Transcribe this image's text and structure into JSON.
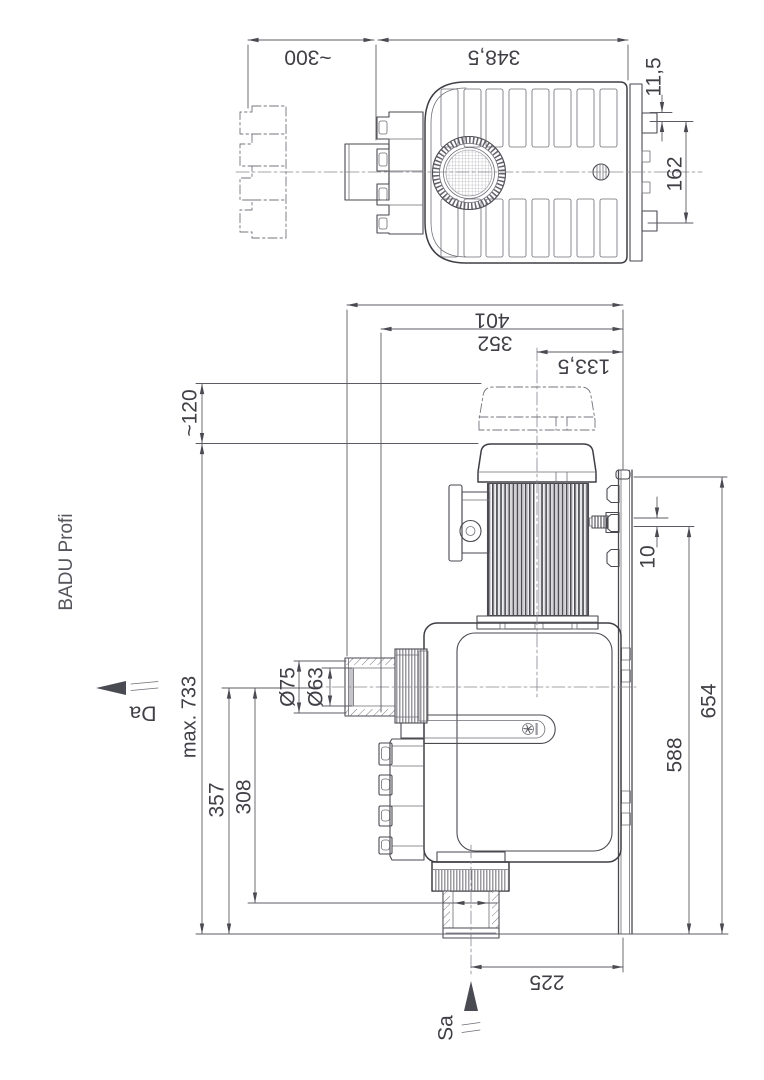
{
  "drawing": {
    "title": "BADU Profi",
    "flow_labels": {
      "discharge": "Da",
      "suction": "Sa"
    },
    "top_view_dims": {
      "removal_clearance": "~300",
      "housing_length": "348,5",
      "flange_offset": "11,5",
      "flange_spacing": "162"
    },
    "front_view_dims": {
      "overall_depth": "401",
      "union_depth": "352",
      "axis_to_wall": "133,5",
      "cover_clearance": "~120",
      "max_height": "max. 733",
      "discharge_axis_height": "357",
      "suction_socket_height": "308",
      "union_outer_diameter": "Ø75",
      "union_inner_diameter": "Ø63",
      "bracket_gap": "10",
      "bracket_top_height": "654",
      "barb_height": "588",
      "suction_axis_to_wall": "225"
    }
  }
}
